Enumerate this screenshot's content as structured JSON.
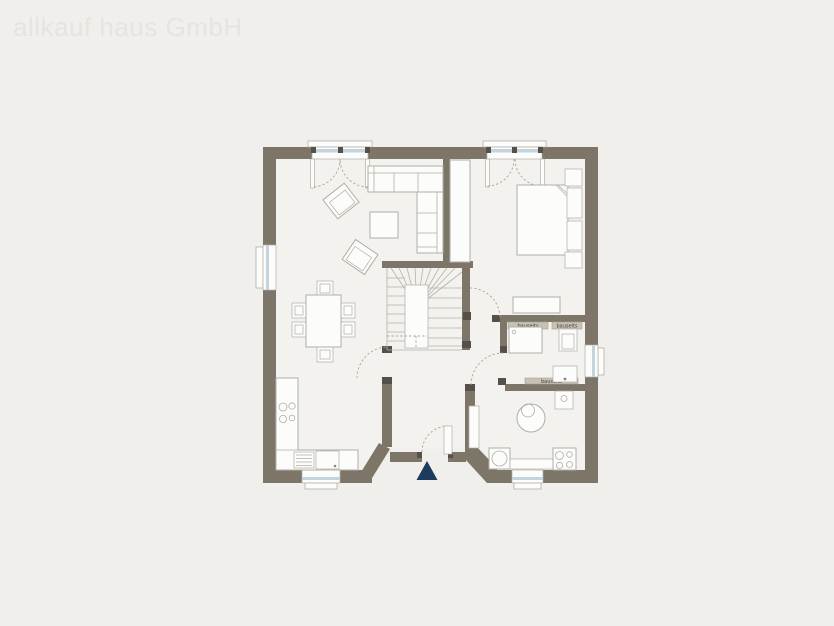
{
  "watermark": {
    "text": "allkauf haus GmbH"
  },
  "plan": {
    "type": "floor-plan",
    "onsite_label": "bauseits",
    "entrance_marker": "triangle"
  },
  "colors": {
    "background": "#f0efeb",
    "room_fill": "#f3f2ee",
    "wall": "#7e7569",
    "furniture_outline": "#b2aea6",
    "fixture_fill": "#fcfcfa",
    "window_glass": "#c3d3df",
    "door_frame": "#55504a",
    "entrance_arrow": "#1e3a5c",
    "counter_onsite": "#c8c2b5",
    "onsite_text": "#3f3b33",
    "watermark": "#e5e4e0",
    "dash": "#a8a49b",
    "stair_line": "#b5b2aa"
  }
}
